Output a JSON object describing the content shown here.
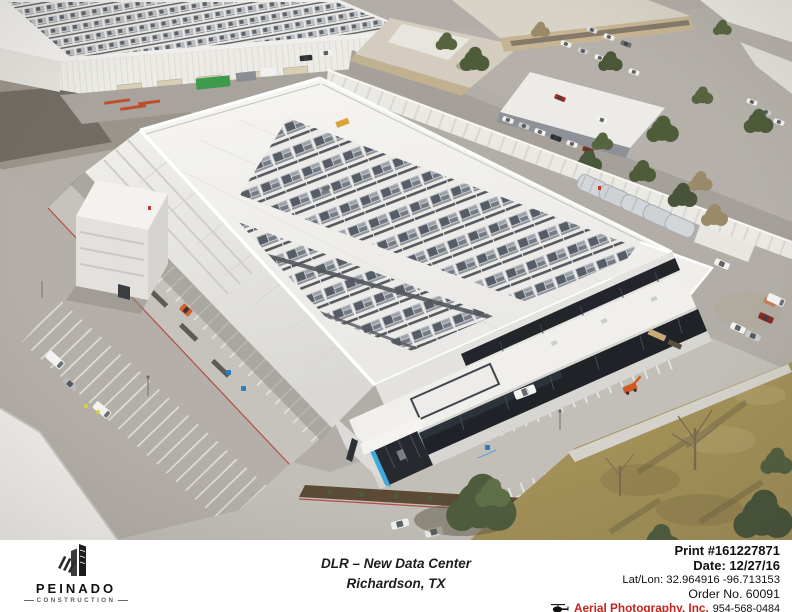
{
  "caption": {
    "logo": {
      "name": "PEINADO",
      "subtitle": "CONSTRUCTION"
    },
    "title_line1": "DLR – New Data Center",
    "title_line2": "Richardson, TX",
    "info": {
      "print": "Print #161227871",
      "date": "Date: 12/27/16",
      "latlon": "Lat/Lon: 32.964916 -96.713153",
      "order": "Order No. 60091",
      "photographer": "Aerial Photography, Inc.",
      "phone": "954-568-0484"
    },
    "icons": {
      "credit_icon": "helicopter-icon",
      "logo_icon": "skyscrapers-icon"
    }
  },
  "colors": {
    "accent_blue": "#3fa9dd",
    "credit_red": "#c42420",
    "logo_black": "#1c1c1c",
    "roof_white": "#f2f1ee",
    "asphalt_gray": "#b2aea7",
    "field_tan": "#a39058",
    "tree_green": "#4e5c3d",
    "container_green": "#3f9b4c"
  }
}
